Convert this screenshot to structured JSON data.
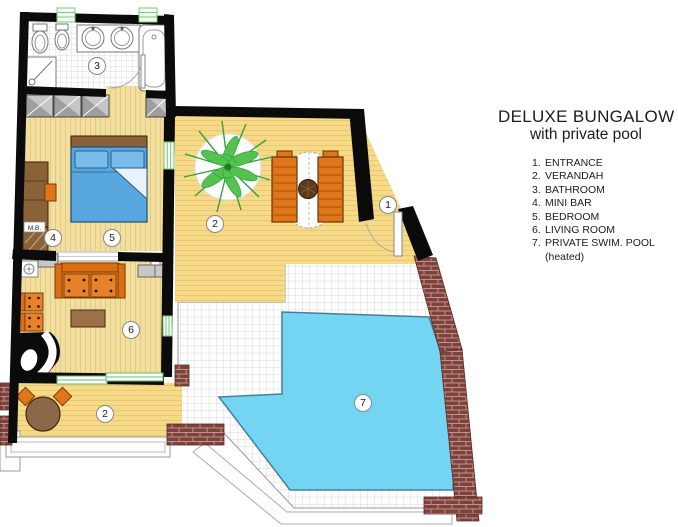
{
  "header": {
    "title": "DELUXE BUNGALOW",
    "subtitle": "with private pool"
  },
  "legend": {
    "items": [
      {
        "num": "1.",
        "label": "ENTRANCE"
      },
      {
        "num": "2.",
        "label": "VERANDAH"
      },
      {
        "num": "3.",
        "label": "BATHROOM"
      },
      {
        "num": "4.",
        "label": "MINI BAR"
      },
      {
        "num": "5.",
        "label": "BEDROOM"
      },
      {
        "num": "6.",
        "label": "LIVING ROOM"
      },
      {
        "num": "7.",
        "label": "PRIVATE SWIM. POOL"
      }
    ],
    "note": "(heated)"
  },
  "plan": {
    "markers": {
      "entrance": "1",
      "verandah": "2",
      "bathroom": "3",
      "mini_bar": "4",
      "bedroom": "5",
      "living_room": "6",
      "pool": "7"
    },
    "minibar_label": "M.B.",
    "colors": {
      "wall": "#0b0b0b",
      "floor_yellow_room": "#F2DE9E",
      "floor_yellow_verandah": "#F6DA88",
      "pool_blue": "#74D5F2",
      "furniture_orange": "#E0751A",
      "wood_brown": "#8A6238",
      "brick_maroon": "#7E413B",
      "plant_green": "#2FA33B",
      "bed_blue": "#58A7DF",
      "window_green": "#7CC87C",
      "tile_line": "#D8D8D8"
    }
  }
}
